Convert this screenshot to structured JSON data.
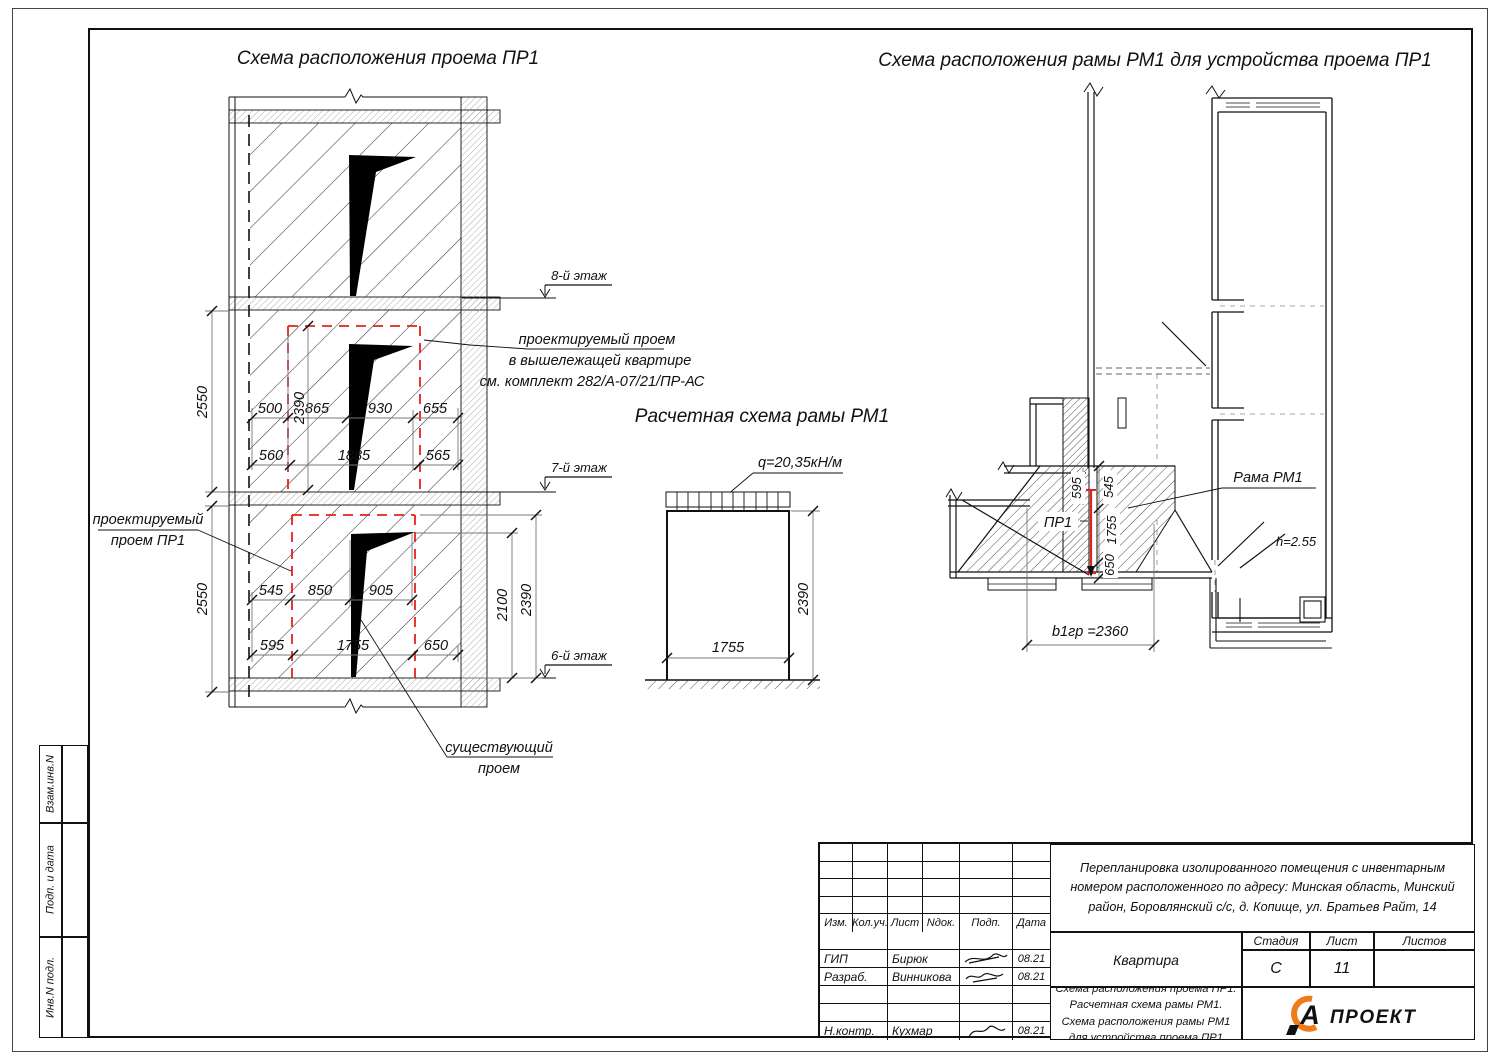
{
  "colors": {
    "red_opening": "#e32219",
    "logo_orange": "#f07c19",
    "line": "#111111",
    "dim_gray": "#777777"
  },
  "strip": {
    "items": [
      "Взам.инв.N",
      "Подп. и дата",
      "Инв.N подл."
    ]
  },
  "elev": {
    "title": "Схема расположения проема ПР1",
    "floors": [
      "8-й этаж",
      "7-й этаж",
      "6-й этаж"
    ],
    "ann_upper": [
      "проектируемый проем",
      "в вышележащей квартире",
      "см. комплект 282/А-07/21/ПР-АС"
    ],
    "ann_left": [
      "проектируемый",
      "проем ПР1"
    ],
    "ann_exist": [
      "существующий",
      "проем"
    ],
    "story_dim": "2550",
    "mid1": [
      "500",
      "865",
      "930",
      "655"
    ],
    "mid1v": "2390",
    "mid2": [
      "560",
      "1885",
      "565"
    ],
    "low1": [
      "545",
      "850",
      "905"
    ],
    "low2": [
      "595",
      "1755",
      "650"
    ],
    "right_v": [
      "2100",
      "2390"
    ]
  },
  "calc": {
    "title": "Расчетная схема рамы РМ1",
    "load": "q=20,35кН/м",
    "w": "1755",
    "h": "2390"
  },
  "plan": {
    "title": "Схема расположения рамы РМ1 для устройства проема ПР1",
    "frame_label": "Рама РМ1",
    "opening_label": "ПР1",
    "room_h": "h=2.55",
    "b_dim": "b1гр =2360",
    "v_dims": [
      "595",
      "545",
      "1755",
      "650"
    ]
  },
  "tb": {
    "cols": [
      "Изм.",
      "Кол.уч.",
      "Лист",
      "Nдок.",
      "Подп.",
      "Дата"
    ],
    "rows": [
      {
        "role": "ГИП",
        "name": "Бирюк",
        "date": "08.21"
      },
      {
        "role": "Разраб.",
        "name": "Винникова",
        "date": "08.21"
      },
      {
        "role": "Н.контр.",
        "name": "Кухмар",
        "date": "08.21"
      }
    ],
    "project": "Перепланировка изолированного помещения с инвентарным номером расположенного по адресу: Минская область, Минский район, Боровлянский с/с, д. Копище, ул. Братьев Райт, 14",
    "object": "Квартира",
    "sheet_title": "Схема расположения проема ПР1. Расчетная схема рамы РМ1. Схема расположения рамы РМ1 для устройства проема ПР1",
    "stage_label": "Стадия",
    "sheet_label": "Лист",
    "sheets_label": "Листов",
    "stage": "С",
    "sheet_num": "11",
    "sheets_num": "",
    "logo_letter": "А",
    "logo_text": "ПРОЕКТ"
  }
}
